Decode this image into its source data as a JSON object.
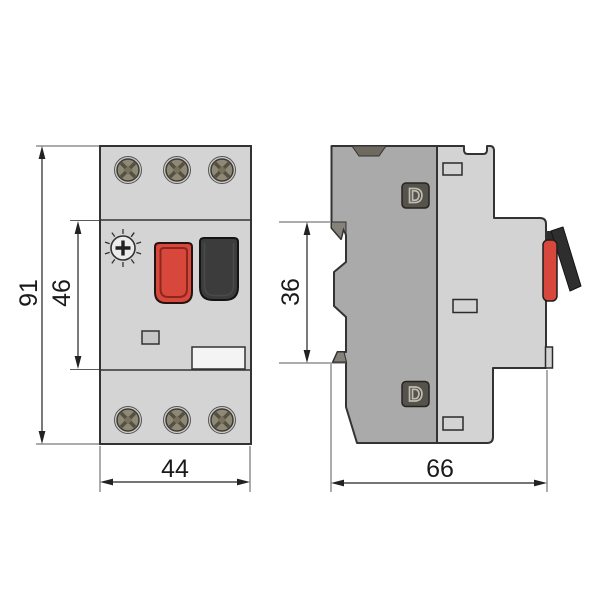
{
  "drawing": {
    "kind": "dimensional-drawing",
    "subject": "motor protection circuit breaker, front and side views"
  },
  "dimensions": {
    "overall_height": "91",
    "mid_section_height": "46",
    "overall_width": "44",
    "din_notch_height": "36",
    "overall_depth": "66"
  },
  "side_view": {
    "terminal_marking_top": "D",
    "terminal_marking_bottom": "D"
  },
  "colors": {
    "body_gray": "#d4d4d4",
    "side_back_gray": "#aaaaaa",
    "red_button": "#d8473b",
    "black_button": "#3c3c3c",
    "screw_head_olive": "#8e8876",
    "badge_dark": "#56534c",
    "outline": "#333333",
    "dimension_line": "#222222"
  }
}
